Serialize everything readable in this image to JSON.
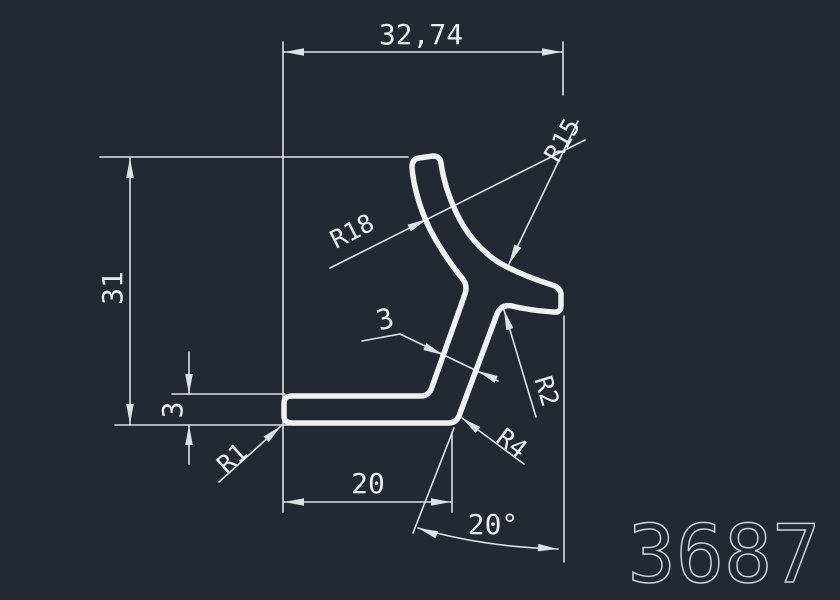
{
  "title": "CAD profile drawing",
  "part_number": "3687",
  "colors": {
    "background": "#242832",
    "profile_line": "#eef0f2",
    "dim_line": "#dde1e6",
    "dim_text": "#eaedf0",
    "part_text": "#ccd1d7"
  },
  "dimensions_summary": {
    "overall_width": "32,74",
    "overall_height": "31",
    "flange_thickness": "3",
    "wall_thickness": "3",
    "flange_length": "20",
    "stem_angle": "20°",
    "radii": [
      "R1",
      "R18",
      "R15",
      "R2",
      "R4"
    ]
  },
  "drawing": {
    "profile": {
      "width": 5.5,
      "d": "M 292,396 L 421,396 Q 429,396 432,387 L 465,294 Q 468,285 462,278 C 452,266 436,243 427,223 C 418,203 413,182 412,167 Q 412,159 419,158 L 433,156 Q 440,156 441,163 C 443,177 448,195 456,212 C 465,232 480,250 498,262 C 515,272 536,280 552,285 Q 560,287 561,294 L 561,306 Q 561,313 553,312 C 540,311 524,309 512,306 Q 501,304 497,314 L 459,416 Q 456,423 448,423 L 292,423 Q 284,423 284,416 L 284,403 Q 284,396 292,396 Z"
    },
    "lines": [
      {
        "x1": 283,
        "y1": 42,
        "x2": 283,
        "y2": 512,
        "name": "ext-line-left-long"
      },
      {
        "x1": 563,
        "y1": 42,
        "x2": 563,
        "y2": 95,
        "name": "ext-line-right-top"
      },
      {
        "x1": 284,
        "y1": 52,
        "x2": 562,
        "y2": 52,
        "name": "dim-line-width"
      },
      {
        "x1": 100,
        "y1": 157,
        "x2": 408,
        "y2": 157,
        "name": "ext-line-31-top"
      },
      {
        "x1": 115,
        "y1": 425,
        "x2": 289,
        "y2": 425,
        "name": "ext-line-31-bottom"
      },
      {
        "x1": 130,
        "y1": 157,
        "x2": 130,
        "y2": 425,
        "name": "dim-line-31"
      },
      {
        "x1": 172,
        "y1": 394,
        "x2": 285,
        "y2": 394,
        "name": "ext-line-3-top"
      },
      {
        "x1": 189,
        "y1": 352,
        "x2": 189,
        "y2": 394,
        "name": "dim-line-3-upper"
      },
      {
        "x1": 189,
        "y1": 425,
        "x2": 189,
        "y2": 464,
        "name": "dim-line-3-lower"
      },
      {
        "x1": 284,
        "y1": 502,
        "x2": 451,
        "y2": 502,
        "name": "dim-line-20"
      },
      {
        "x1": 452,
        "y1": 432,
        "x2": 452,
        "y2": 512,
        "name": "ext-line-20-right"
      },
      {
        "x1": 454,
        "y1": 428,
        "x2": 413,
        "y2": 533,
        "name": "ext-line-stem-angle"
      },
      {
        "x1": 564,
        "y1": 316,
        "x2": 564,
        "y2": 562,
        "name": "ext-line-angle-vertical"
      },
      {
        "x1": 219,
        "y1": 482,
        "x2": 281,
        "y2": 426,
        "name": "leader-r1"
      },
      {
        "x1": 330,
        "y1": 268,
        "x2": 585,
        "y2": 140,
        "name": "leader-r18"
      },
      {
        "x1": 509,
        "y1": 264,
        "x2": 578,
        "y2": 121,
        "name": "leader-r15"
      },
      {
        "x1": 504,
        "y1": 310,
        "x2": 536,
        "y2": 417,
        "name": "leader-r2"
      },
      {
        "x1": 462,
        "y1": 418,
        "x2": 524,
        "y2": 464,
        "name": "leader-r4"
      },
      {
        "x1": 362,
        "y1": 341,
        "x2": 400,
        "y2": 334,
        "name": "leader-3-tail"
      },
      {
        "x1": 400,
        "y1": 334,
        "x2": 498,
        "y2": 381,
        "name": "leader-3-main"
      }
    ],
    "paths": [
      {
        "d": "M 418,528 Q 483,547 558,549",
        "name": "dim-arc-20deg"
      }
    ],
    "arrows": [
      {
        "x": 284,
        "y": 52,
        "a": 180,
        "name": "arrowhead-width-left"
      },
      {
        "x": 562,
        "y": 52,
        "a": 0,
        "name": "arrowhead-width-right"
      },
      {
        "x": 130,
        "y": 158,
        "a": -90,
        "name": "arrowhead-31-top"
      },
      {
        "x": 130,
        "y": 424,
        "a": 90,
        "name": "arrowhead-31-bottom"
      },
      {
        "x": 189,
        "y": 394,
        "a": 90,
        "name": "arrowhead-3-upper"
      },
      {
        "x": 189,
        "y": 425,
        "a": -90,
        "name": "arrowhead-3-lower"
      },
      {
        "x": 284,
        "y": 502,
        "a": 180,
        "name": "arrowhead-20-left"
      },
      {
        "x": 451,
        "y": 502,
        "a": 0,
        "name": "arrowhead-20-right"
      },
      {
        "x": 418,
        "y": 528,
        "a": 200,
        "name": "arrowhead-angle-left"
      },
      {
        "x": 558,
        "y": 549,
        "a": 4,
        "name": "arrowhead-angle-right"
      },
      {
        "x": 281,
        "y": 426,
        "a": -42,
        "name": "arrowhead-r1"
      },
      {
        "x": 427,
        "y": 219,
        "a": -27,
        "name": "arrowhead-r18"
      },
      {
        "x": 509,
        "y": 264,
        "a": 116,
        "name": "arrowhead-r15"
      },
      {
        "x": 504,
        "y": 310,
        "a": -107,
        "name": "arrowhead-r2"
      },
      {
        "x": 462,
        "y": 418,
        "a": -143,
        "name": "arrowhead-r4"
      },
      {
        "x": 443,
        "y": 355,
        "a": 25,
        "name": "arrowhead-3wall-left"
      },
      {
        "x": 478,
        "y": 371,
        "a": 205,
        "name": "arrowhead-3wall-right"
      }
    ],
    "texts": [
      {
        "label": "32,74",
        "x": 421,
        "y": 34,
        "rot": 0,
        "size": 28,
        "name": "dim-text-width"
      },
      {
        "label": "31",
        "x": 112,
        "y": 288,
        "rot": -90,
        "size": 28,
        "name": "dim-text-height"
      },
      {
        "label": "3",
        "x": 172,
        "y": 410,
        "rot": -90,
        "size": 28,
        "name": "dim-text-flange-thickness"
      },
      {
        "label": "20",
        "x": 368,
        "y": 483,
        "rot": 0,
        "size": 28,
        "name": "dim-text-flange-length"
      },
      {
        "label": "20°",
        "x": 493,
        "y": 524,
        "rot": 0,
        "size": 28,
        "name": "dim-text-angle"
      },
      {
        "label": "R1",
        "x": 232,
        "y": 458,
        "rot": -42,
        "size": 25,
        "name": "radius-text-r1"
      },
      {
        "label": "R18",
        "x": 352,
        "y": 231,
        "rot": -27,
        "size": 25,
        "name": "radius-text-r18"
      },
      {
        "label": "R15",
        "x": 562,
        "y": 140,
        "rot": -60,
        "size": 25,
        "name": "radius-text-r15"
      },
      {
        "label": "R2",
        "x": 547,
        "y": 391,
        "rot": 73,
        "size": 25,
        "name": "radius-text-r2"
      },
      {
        "label": "R4",
        "x": 512,
        "y": 443,
        "rot": 37,
        "size": 25,
        "name": "radius-text-r4"
      },
      {
        "label": "3",
        "x": 385,
        "y": 319,
        "rot": -15,
        "size": 28,
        "name": "dim-text-wall-thickness"
      },
      {
        "label": "3687",
        "x": 724,
        "y": 554,
        "rot": 0,
        "size": 80,
        "mode": "stroke",
        "name": "part-number"
      }
    ]
  }
}
